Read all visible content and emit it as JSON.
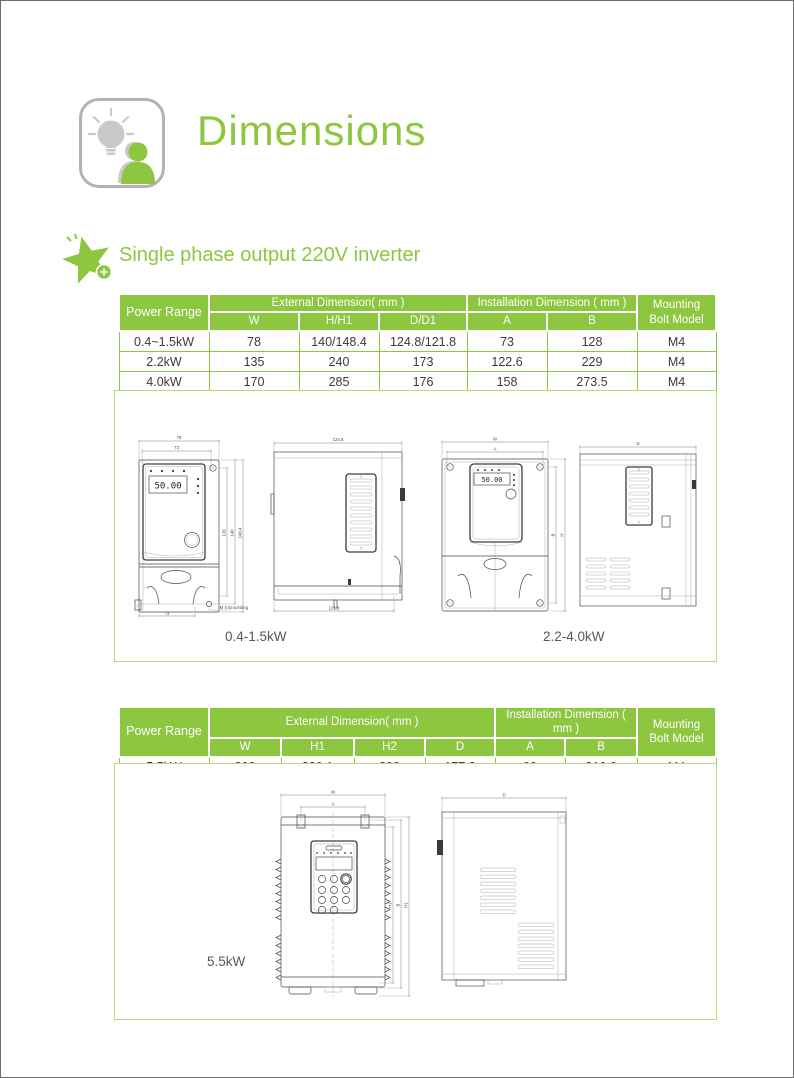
{
  "page": {
    "title": "Dimensions",
    "section_heading": "Single phase output 220V inverter"
  },
  "colors": {
    "accent_green": "#8dc63f",
    "box_border_green": "#b6db7a",
    "body_text": "#3e3a39"
  },
  "icons": {
    "header_icon": "lightbulb-person-icon",
    "section_icon": "star-plus-icon"
  },
  "table1": {
    "power_range_label": "Power Range",
    "external_label": "External Dimension( mm )",
    "installation_label": "Installation Dimension ( mm )",
    "mounting_label_line1": "Mounting",
    "mounting_label_line2": "Bolt Model",
    "subcols": [
      "W",
      "H/H1",
      "D/D1",
      "A",
      "B"
    ],
    "rows": [
      [
        "0.4~1.5kW",
        "78",
        "140/148.4",
        "124.8/121.8",
        "73",
        "128",
        "M4"
      ],
      [
        "2.2kW",
        "135",
        "240",
        "173",
        "122.6",
        "229",
        "M4"
      ],
      [
        "4.0kW",
        "170",
        "285",
        "176",
        "158",
        "273.5",
        "M4"
      ]
    ]
  },
  "table2": {
    "power_range_label": "Power Range",
    "external_label": "External Dimension( mm )",
    "installation_label": "Installation Dimension ( mm )",
    "mounting_label_line1": "Mounting",
    "mounting_label_line2": "Bolt Model",
    "subcols": [
      "W",
      "H1",
      "H2",
      "D",
      "A",
      "B"
    ],
    "rows": [
      [
        "5.5kW",
        "200",
        "329.1",
        "300",
        "177.2",
        "90",
        "316.6",
        "M4"
      ]
    ]
  },
  "drawings": {
    "caption_small": "0.4-1.5kW",
    "caption_mid": "2.2-4.0kW",
    "caption_large": "5.5kW",
    "display_value": "50.00",
    "d1": {
      "top_outer": "78",
      "top_inner": "73",
      "right_inner": "128",
      "right_mid": "140",
      "right_outer": "148.4",
      "bottom": "73",
      "note": "M 4 Grounding"
    },
    "d2": {
      "top": "124.8",
      "bottom": "121.8"
    },
    "d3": {
      "top_outer": "W",
      "top_inner": "A",
      "right_inner": "B",
      "right_outer": "H"
    },
    "d4": {
      "top": "D"
    },
    "d5": {
      "top_outer": "W",
      "top_inner": "A",
      "right_1": "H2",
      "right_2": "B",
      "right_3": "H1"
    },
    "d6": {
      "top": "D"
    }
  }
}
